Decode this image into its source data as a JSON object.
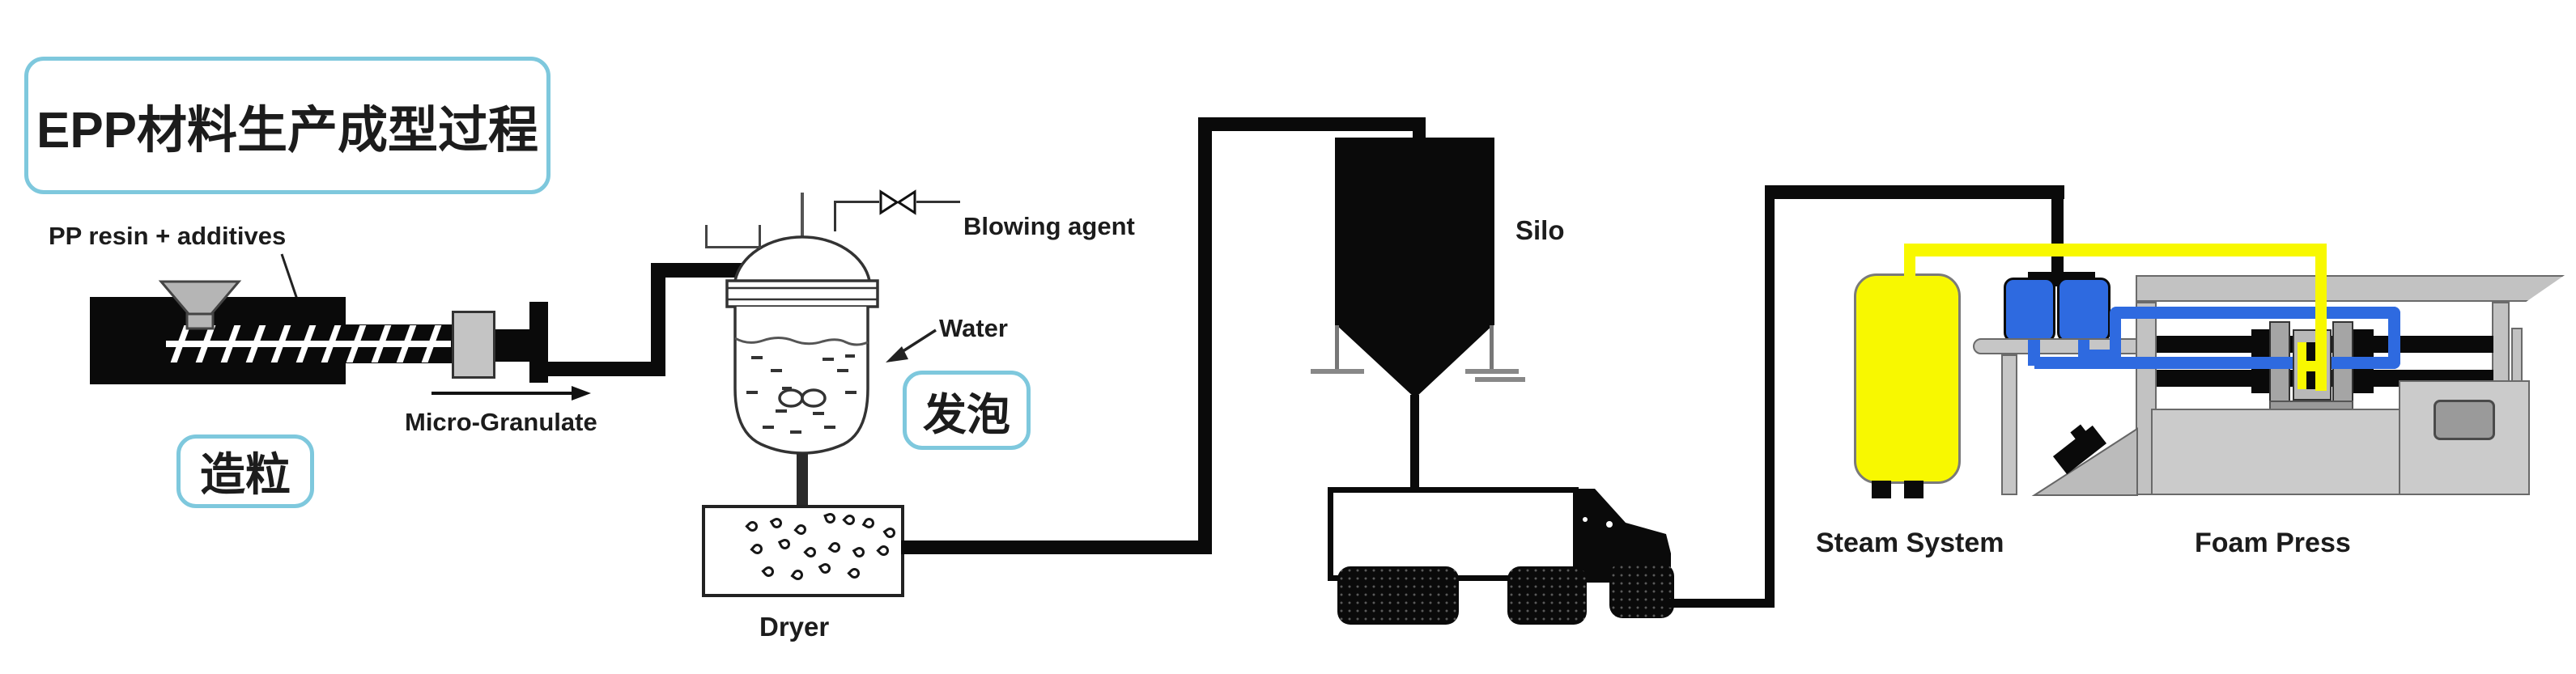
{
  "title": {
    "text": "EPP材料生产成型过程"
  },
  "stages": {
    "granulation": "造粒",
    "foaming": "发泡"
  },
  "labels": {
    "pp_resin": "PP resin + additives",
    "micro_granulate": "Micro-Granulate",
    "blowing_agent": "Blowing agent",
    "water": "Water",
    "dryer": "Dryer",
    "silo": "Silo",
    "steam_system": "Steam System",
    "foam_press": "Foam Press"
  },
  "colors": {
    "accent_border": "#7EC8DD",
    "pipe_yellow": "#F8F800",
    "pipe_blue": "#2E6AE0",
    "machine_gray": "#C8C8C8",
    "line_black": "#0A0A0A"
  }
}
